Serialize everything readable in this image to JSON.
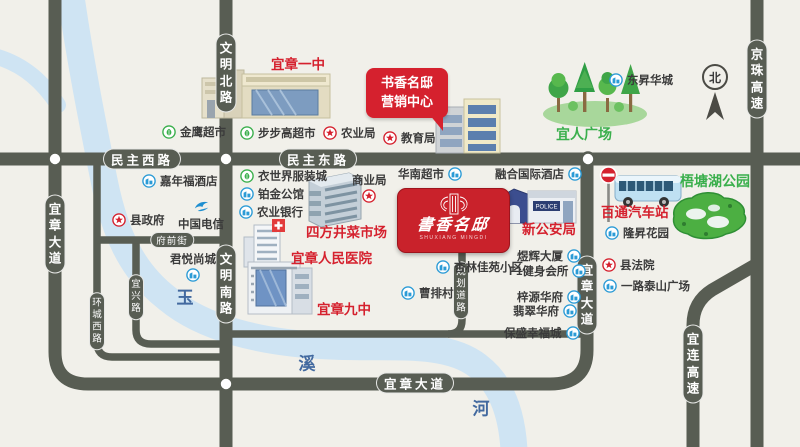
{
  "colors": {
    "road": "#585d53",
    "river": "#cfe4f3",
    "red": "#d5212e",
    "green": "#3aaf4c",
    "blue": "#2b9bd6",
    "paper": "#f1f0ea"
  },
  "compass": {
    "north_label": "北"
  },
  "logo": {
    "name": "書香名邸",
    "sub": "SHUXIANG MINGDI"
  },
  "callout": {
    "line1": "书香名邸",
    "line2": "营销中心"
  },
  "buildings": {
    "police_sign": "POLICE"
  },
  "river_labels": [
    {
      "name": "river-char-yu",
      "text": "玉",
      "x": 185,
      "y": 296
    },
    {
      "name": "river-char-xi",
      "text": "溪",
      "x": 307,
      "y": 362
    },
    {
      "name": "river-char-he",
      "text": "河",
      "x": 481,
      "y": 407
    }
  ],
  "road_labels": [
    {
      "name": "road-wenming-north-rd",
      "label": "文明北路",
      "o": "v",
      "cls": "major",
      "x": 226,
      "y": 73
    },
    {
      "name": "road-wenming-south-rd",
      "label": "文明南路",
      "o": "v",
      "cls": "major",
      "x": 226,
      "y": 284
    },
    {
      "name": "road-minzhu-west-rd",
      "label": "民主西路",
      "o": "h",
      "cls": "major",
      "x": 142,
      "y": 159
    },
    {
      "name": "road-minzhu-east-rd",
      "label": "民主东路",
      "o": "h",
      "cls": "major",
      "x": 318,
      "y": 159
    },
    {
      "name": "road-yizhang-ave-west",
      "label": "宜章大道",
      "o": "v",
      "cls": "major",
      "x": 55,
      "y": 234
    },
    {
      "name": "road-yizhang-ave-south",
      "label": "宜章大道",
      "o": "h",
      "cls": "major",
      "x": 415,
      "y": 383
    },
    {
      "name": "road-yizhang-ave-east",
      "label": "宜章大道",
      "o": "v",
      "cls": "major",
      "x": 587,
      "y": 295
    },
    {
      "name": "road-jingzhu-expressway",
      "label": "京珠高速",
      "o": "v",
      "cls": "major",
      "x": 757,
      "y": 79
    },
    {
      "name": "road-yilian-expressway",
      "label": "宜连高速",
      "o": "v",
      "cls": "major",
      "x": 693,
      "y": 364
    },
    {
      "name": "road-fuqian-street",
      "label": "府前街",
      "o": "h",
      "cls": "minor",
      "x": 172,
      "y": 240
    },
    {
      "name": "road-huancheng-west-rd",
      "label": "环城西路",
      "o": "v",
      "cls": "minor",
      "x": 97,
      "y": 321
    },
    {
      "name": "road-yixing-rd",
      "label": "宜兴路",
      "o": "v",
      "cls": "minor",
      "x": 136,
      "y": 297
    },
    {
      "name": "road-planned-rd",
      "label": "规划道路",
      "o": "v",
      "cls": "minor",
      "x": 461,
      "y": 290
    }
  ],
  "markers": [
    {
      "name": "poi-jinying-supermarket",
      "label": "金鹰超市",
      "icon": "green",
      "pos": "l",
      "x": 162,
      "y": 132
    },
    {
      "name": "poi-bubugao-supermarket",
      "label": "步步高超市",
      "icon": "green",
      "pos": "l",
      "x": 240,
      "y": 133
    },
    {
      "name": "poi-yishijie-clothing-city",
      "label": "衣世界服装城",
      "icon": "green",
      "pos": "l",
      "x": 240,
      "y": 176
    },
    {
      "name": "poi-agriculture-bureau",
      "label": "农业局",
      "icon": "star",
      "pos": "l",
      "x": 323,
      "y": 133
    },
    {
      "name": "poi-education-bureau",
      "label": "教育局",
      "icon": "star",
      "pos": "l",
      "x": 383,
      "y": 138
    },
    {
      "name": "poi-county-government",
      "label": "县政府",
      "icon": "star",
      "pos": "l",
      "x": 112,
      "y": 220
    },
    {
      "name": "poi-commerce-bureau",
      "label": "商业局",
      "icon": "star",
      "pos": "b",
      "x": 352,
      "y": 172
    },
    {
      "name": "poi-county-court",
      "label": "县法院",
      "icon": "star",
      "pos": "l",
      "x": 602,
      "y": 265
    },
    {
      "name": "poi-china-telecom",
      "label": "中国电信",
      "icon": "tel",
      "pos": "t",
      "x": 178,
      "y": 198
    },
    {
      "name": "poi-jianianfu-hotel",
      "label": "嘉年福酒店",
      "icon": "blue",
      "pos": "l",
      "x": 142,
      "y": 181
    },
    {
      "name": "poi-bojin-mansion",
      "label": "铂金公馆",
      "icon": "blue",
      "pos": "l",
      "x": 240,
      "y": 194
    },
    {
      "name": "poi-agricultural-bank",
      "label": "农业银行",
      "icon": "blue",
      "pos": "l",
      "x": 239,
      "y": 212
    },
    {
      "name": "poi-junyue-shangcheng",
      "label": "君悦尚城",
      "icon": "blue",
      "pos": "b",
      "x": 170,
      "y": 251
    },
    {
      "name": "poi-huanan-supermarket",
      "label": "华南超市",
      "icon": "blue",
      "pos": "r",
      "x": 398,
      "y": 174
    },
    {
      "name": "poi-ronghe-intl-hotel",
      "label": "融合国际酒店",
      "icon": "blue",
      "pos": "r",
      "x": 495,
      "y": 174
    },
    {
      "name": "poi-dongsheng-huacheng",
      "label": "东昇华城",
      "icon": "blue",
      "pos": "l",
      "x": 609,
      "y": 80
    },
    {
      "name": "poi-longsheng-garden",
      "label": "隆昇花园",
      "icon": "blue",
      "pos": "l",
      "x": 605,
      "y": 233
    },
    {
      "name": "poi-yilutaishan-plaza",
      "label": "一路泰山广场",
      "icon": "blue",
      "pos": "l",
      "x": 603,
      "y": 286
    },
    {
      "name": "poi-xinglin-jiayuan",
      "label": "杏林佳苑小区",
      "icon": "blue",
      "pos": "l",
      "x": 436,
      "y": 267
    },
    {
      "name": "poi-caopai-village",
      "label": "曹排村",
      "icon": "blue",
      "pos": "l",
      "x": 401,
      "y": 293
    },
    {
      "name": "poi-yuhui-tower",
      "label": "煜辉大厦",
      "icon": "blue",
      "pos": "r",
      "x": 517,
      "y": 256
    },
    {
      "name": "poi-f1-fitness-club",
      "label": "F1健身会所",
      "icon": "blue",
      "pos": "r",
      "x": 509,
      "y": 271
    },
    {
      "name": "poi-zihyuan-huafu",
      "label": "梓源华府",
      "icon": "blue",
      "pos": "r",
      "x": 517,
      "y": 297
    },
    {
      "name": "poi-feicui-huafu",
      "label": "翡翠华府",
      "icon": "blue",
      "pos": "r",
      "x": 513,
      "y": 311
    },
    {
      "name": "poi-baosheng-xingfucheng",
      "label": "保盛幸福城",
      "icon": "blue",
      "pos": "r",
      "x": 504,
      "y": 333
    },
    {
      "name": "poi-yizhang-no1-school",
      "label": "宜章一中",
      "icon": "none",
      "pos": "l",
      "cls": "red",
      "x": 271,
      "y": 63
    },
    {
      "name": "poi-jinxiu-school",
      "label": "进修学校",
      "icon": "none",
      "pos": "l",
      "cls": "red",
      "x": 394,
      "y": 92
    },
    {
      "name": "poi-sifangjing-market",
      "label": "四方井菜市场",
      "icon": "none",
      "pos": "l",
      "cls": "red",
      "x": 306,
      "y": 231
    },
    {
      "name": "poi-yizhang-peoples-hospital",
      "label": "宜章人民医院",
      "icon": "none",
      "pos": "l",
      "cls": "red",
      "x": 291,
      "y": 257
    },
    {
      "name": "poi-yizhang-no9-school",
      "label": "宜章九中",
      "icon": "none",
      "pos": "l",
      "cls": "red",
      "x": 317,
      "y": 308
    },
    {
      "name": "poi-new-public-security-bureau",
      "label": "新公安局",
      "icon": "none",
      "pos": "l",
      "cls": "red",
      "x": 522,
      "y": 228
    },
    {
      "name": "poi-baitong-bus-station",
      "label": "百通汽车站",
      "icon": "none",
      "pos": "l",
      "cls": "red",
      "x": 601,
      "y": 211
    },
    {
      "name": "poi-yiren-plaza",
      "label": "宜人广场",
      "icon": "none",
      "pos": "l",
      "cls": "greenTxt",
      "x": 556,
      "y": 134
    },
    {
      "name": "poi-wutang-lake-park",
      "label": "梧塘湖公园",
      "icon": "none",
      "pos": "l",
      "cls": "greenTxt",
      "x": 680,
      "y": 181
    }
  ]
}
